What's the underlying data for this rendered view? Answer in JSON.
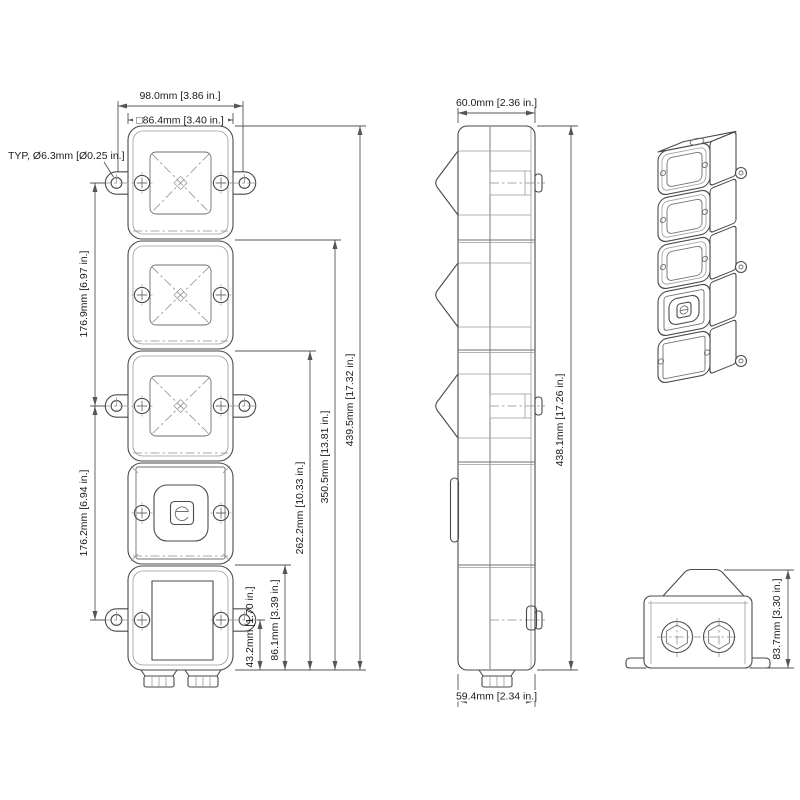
{
  "drawing": {
    "front": {
      "dim_width_overall": "98.0mm [3.86 in.]",
      "dim_width_body": "□86.4mm [3.40 in.]",
      "note_mount_hole": "TYP, Ø6.3mm [Ø0.25 in.]",
      "dim_pitch_upper": "176.9mm [6.97 in.]",
      "dim_pitch_lower": "176.2mm [6.94 in.]",
      "dim_h_gland": "43.2mm [1.70 in.]",
      "dim_h_base": "86.1mm [3.39 in.]",
      "dim_h_mid": "262.2mm [10.33 in.]",
      "dim_h_upper": "350.5mm [13.81 in.]",
      "dim_h_total": "439.5mm [17.32 in.]"
    },
    "side": {
      "dim_depth_top": "60.0mm [2.36 in.]",
      "dim_height_total": "438.1mm [17.26 in.]",
      "dim_depth_bottom": "59.4mm [2.34 in.]"
    },
    "rear": {
      "dim_height": "83.7mm [3.30 in.]"
    }
  }
}
